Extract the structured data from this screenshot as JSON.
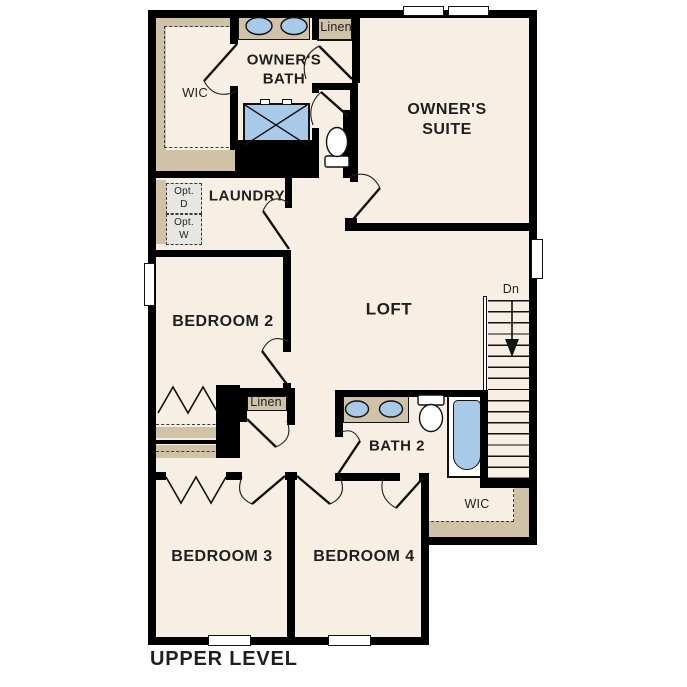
{
  "plan": {
    "title": "UPPER LEVEL",
    "rooms": {
      "owners_suite": "OWNER'S SUITE",
      "owners_bath": "OWNER'S BATH",
      "owners_wic": "WIC",
      "linen_top": "Linen",
      "laundry": "LAUNDRY",
      "opt_dryer": "Opt.\nD",
      "opt_washer": "Opt.\nW",
      "bedroom2": "BEDROOM 2",
      "loft": "LOFT",
      "stairs_down": "Dn",
      "linen_hall": "Linen",
      "bath2": "BATH 2",
      "bedroom4_wic": "WIC",
      "bedroom3": "BEDROOM 3",
      "bedroom4": "BEDROOM 4"
    },
    "colors": {
      "floor": "#f7efe4",
      "wall": "#000000",
      "casework": "#cfc2a6",
      "fixture_blue": "#a9c9e9",
      "appliance_gray": "#e5e7e2",
      "background": "#ffffff",
      "text": "#1f1f1f"
    }
  }
}
